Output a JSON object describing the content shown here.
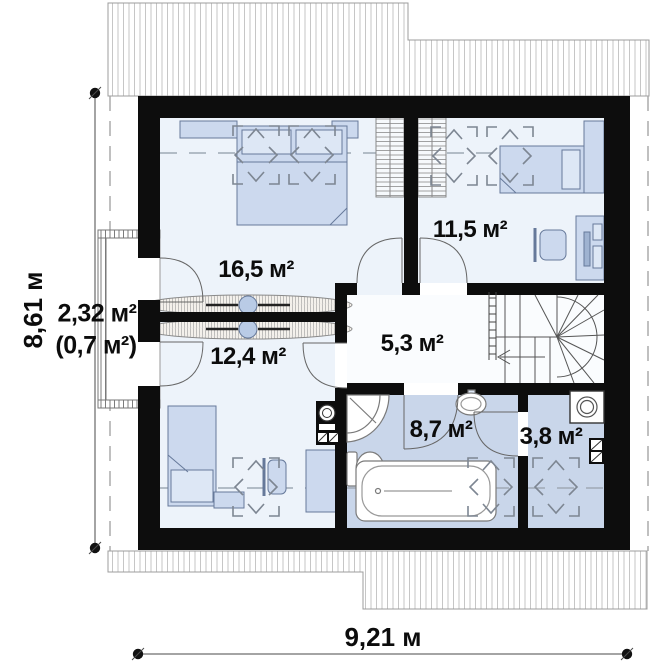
{
  "plan": {
    "type": "attic-floor-plan",
    "dimensions": {
      "width_label": "9,21 м",
      "height_label": "8,61 м"
    },
    "rooms": [
      {
        "name": "bedroom-1",
        "area_label": "16,5 м²"
      },
      {
        "name": "bedroom-2",
        "area_label": "11,5 м²"
      },
      {
        "name": "balcony",
        "area_label": "2,32 м²",
        "area_note": "(0,7 м²)"
      },
      {
        "name": "bedroom-3",
        "area_label": "12,4 м²"
      },
      {
        "name": "hall",
        "area_label": "5,3 м²"
      },
      {
        "name": "bathroom",
        "area_label": "8,7 м²"
      },
      {
        "name": "laundry",
        "area_label": "3,8 м²"
      }
    ],
    "colors": {
      "wall": "#0d0d0d",
      "room_light": "#edf3fa",
      "room_wet": "#c9d6ea",
      "furniture": "#ccd9ee",
      "hall": "#fafcfe"
    }
  }
}
